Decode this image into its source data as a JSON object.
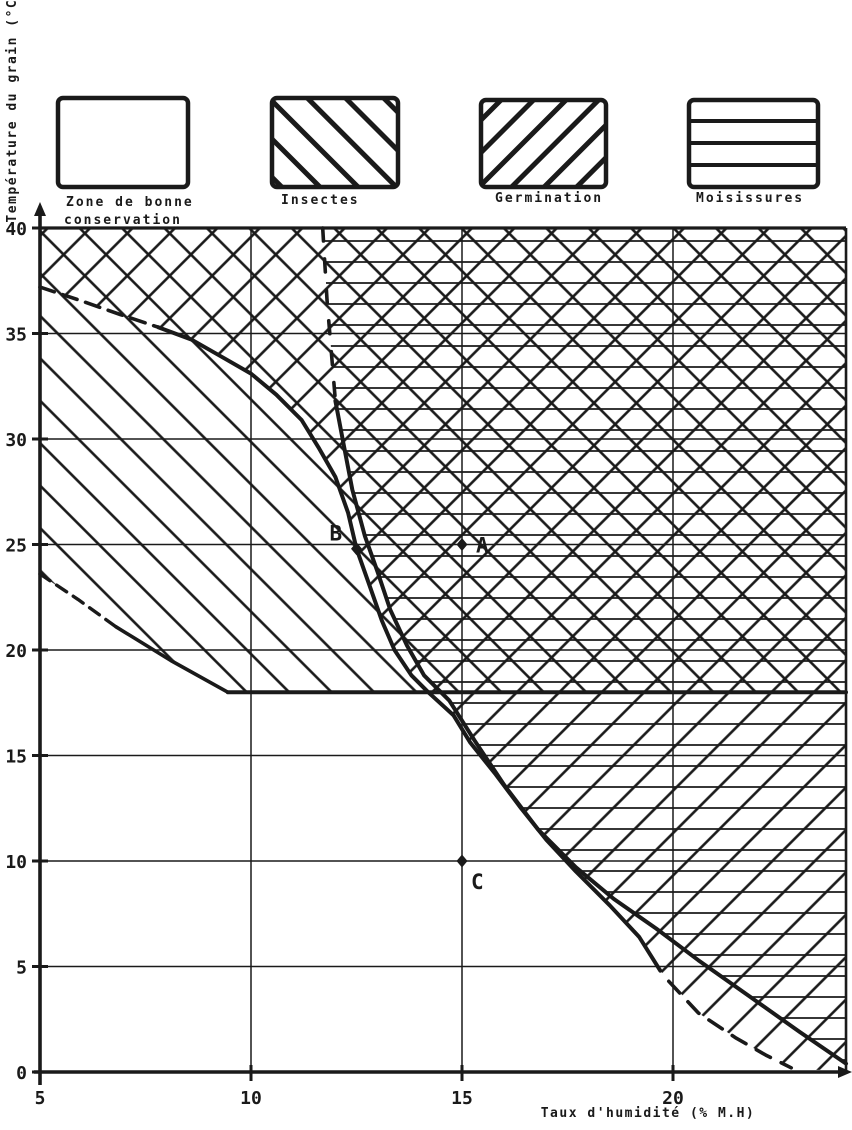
{
  "figure": {
    "bg": "#ffffff",
    "ink": "#1a1a1a"
  },
  "legend": {
    "items": [
      {
        "id": "zone-bonne-conservation",
        "label": "Zone de bonne conservation",
        "label_line1": "Zone de bonne",
        "label_line2": "conservation",
        "pattern": "none"
      },
      {
        "id": "insectes",
        "label": "Insectes",
        "pattern": "diagonal-down"
      },
      {
        "id": "germination",
        "label": "Germination",
        "pattern": "diagonal-up"
      },
      {
        "id": "moisissures",
        "label": "Moisissures",
        "pattern": "horizontal"
      }
    ]
  },
  "chart_data": {
    "type": "area",
    "xlabel": "Taux d'humidité (% M.H)",
    "ylabel": "Température du grain (°C)",
    "x_axis": {
      "range": [
        5,
        24.1
      ],
      "gridlines": [
        10,
        15,
        20
      ],
      "tick_labels": [
        {
          "v": 5,
          "t": "5"
        },
        {
          "v": 10,
          "t": "10"
        },
        {
          "v": 15,
          "t": "15"
        },
        {
          "v": 20,
          "t": "20"
        }
      ]
    },
    "y_axis": {
      "range": [
        0,
        40
      ],
      "gridlines": [
        5,
        10,
        15,
        20,
        25,
        30,
        35
      ],
      "tick_labels": [
        {
          "v": 0,
          "t": "0"
        },
        {
          "v": 5,
          "t": "5"
        },
        {
          "v": 10,
          "t": "10"
        },
        {
          "v": 15,
          "t": "15"
        },
        {
          "v": 20,
          "t": "20"
        },
        {
          "v": 25,
          "t": "25"
        },
        {
          "v": 30,
          "t": "30"
        },
        {
          "v": 35,
          "t": "35"
        },
        {
          "v": 40,
          "t": "40"
        }
      ]
    },
    "calibration": {
      "x": {
        "d0": 5,
        "px0": 40,
        "k": 42.2
      },
      "y": {
        "d0": 0,
        "px0": 1072,
        "k": -21.1
      }
    },
    "zones": [
      {
        "id": "insectes",
        "pattern": "pat-bs",
        "points": [
          [
            5,
            23.6
          ],
          [
            6.8,
            21.1
          ],
          [
            9.45,
            18
          ],
          [
            24.1,
            18
          ],
          [
            24.1,
            40
          ],
          [
            5,
            40
          ]
        ]
      },
      {
        "id": "germination",
        "pattern": "pat-fs",
        "points": [
          [
            5,
            40
          ],
          [
            5,
            37.2
          ],
          [
            5.9,
            36.6
          ],
          [
            6.9,
            35.9
          ],
          [
            7.8,
            35.3
          ],
          [
            8.6,
            34.7
          ],
          [
            9.3,
            33.9
          ],
          [
            10,
            33.1
          ],
          [
            10.6,
            32.1
          ],
          [
            11.2,
            30.9
          ],
          [
            11.6,
            29.6
          ],
          [
            12,
            28.2
          ],
          [
            12.3,
            26.5
          ],
          [
            12.5,
            24.8
          ],
          [
            12.8,
            23.1
          ],
          [
            13.1,
            21.4
          ],
          [
            13.4,
            20
          ],
          [
            13.8,
            18.8
          ],
          [
            14.2,
            18
          ],
          [
            14.8,
            16.9
          ],
          [
            15.2,
            15.6
          ],
          [
            15.8,
            14.1
          ],
          [
            16.4,
            12.5
          ],
          [
            17,
            11
          ],
          [
            17.7,
            9.5
          ],
          [
            18.5,
            7.9
          ],
          [
            19.2,
            6.4
          ],
          [
            19.7,
            4.8
          ],
          [
            20.6,
            2.8
          ],
          [
            21.5,
            1.6
          ],
          [
            22.2,
            0.8
          ],
          [
            22.8,
            0.1
          ],
          [
            24.1,
            0.1
          ],
          [
            24.1,
            40
          ]
        ]
      },
      {
        "id": "moisissures",
        "pattern": "pat-hz",
        "points": [
          [
            11.7,
            40
          ],
          [
            11.8,
            36.6
          ],
          [
            11.9,
            34.2
          ],
          [
            12,
            31.8
          ],
          [
            12.2,
            29.7
          ],
          [
            12.4,
            27.6
          ],
          [
            12.7,
            25.4
          ],
          [
            13,
            23.7
          ],
          [
            13.3,
            21.9
          ],
          [
            13.7,
            20.2
          ],
          [
            14.1,
            18.8
          ],
          [
            14.7,
            17.6
          ],
          [
            15.3,
            15.7
          ],
          [
            16,
            13.6
          ],
          [
            16.8,
            11.5
          ],
          [
            17.7,
            9.7
          ],
          [
            18.6,
            8.2
          ],
          [
            19.6,
            6.8
          ],
          [
            20.6,
            5.3
          ],
          [
            21.8,
            3.6
          ],
          [
            23,
            1.9
          ],
          [
            24.1,
            0.4
          ],
          [
            24.1,
            40
          ]
        ]
      }
    ],
    "curves": [
      {
        "id": "germination-upper-dashed",
        "width": 3.6,
        "dash": "15 9",
        "points": [
          [
            5,
            37.2
          ],
          [
            5.9,
            36.6
          ],
          [
            6.9,
            35.9
          ],
          [
            7.8,
            35.3
          ]
        ]
      },
      {
        "id": "germination-main",
        "width": 4,
        "dash": null,
        "points": [
          [
            7.8,
            35.3
          ],
          [
            8.6,
            34.7
          ],
          [
            9.3,
            33.9
          ],
          [
            10,
            33.1
          ],
          [
            10.6,
            32.1
          ],
          [
            11.2,
            30.9
          ],
          [
            11.6,
            29.6
          ],
          [
            12,
            28.2
          ],
          [
            12.3,
            26.5
          ],
          [
            12.5,
            24.8
          ],
          [
            12.8,
            23.1
          ],
          [
            13.1,
            21.4
          ],
          [
            13.4,
            20
          ],
          [
            13.8,
            18.8
          ],
          [
            14.2,
            18
          ],
          [
            14.8,
            16.9
          ],
          [
            15.2,
            15.6
          ],
          [
            15.8,
            14.1
          ],
          [
            16.4,
            12.5
          ],
          [
            17,
            11
          ],
          [
            17.7,
            9.5
          ],
          [
            18.5,
            7.9
          ],
          [
            19.2,
            6.4
          ],
          [
            19.7,
            4.8
          ]
        ]
      },
      {
        "id": "germination-lower-dashed",
        "width": 3.6,
        "dash": "16 12",
        "points": [
          [
            19.9,
            4.3
          ],
          [
            20.6,
            2.8
          ],
          [
            21.5,
            1.6
          ],
          [
            22.2,
            0.8
          ],
          [
            22.8,
            0.2
          ]
        ]
      },
      {
        "id": "moisissures-upper-dashed",
        "width": 3.6,
        "dash": "13 18",
        "points": [
          [
            11.7,
            40
          ],
          [
            11.8,
            36.6
          ],
          [
            11.9,
            34.2
          ],
          [
            12,
            31.8
          ]
        ]
      },
      {
        "id": "moisissures-main",
        "width": 4,
        "dash": null,
        "points": [
          [
            12,
            31.8
          ],
          [
            12.2,
            29.7
          ],
          [
            12.4,
            27.6
          ],
          [
            12.7,
            25.4
          ],
          [
            13,
            23.7
          ],
          [
            13.3,
            21.9
          ],
          [
            13.7,
            20.2
          ],
          [
            14.1,
            18.8
          ],
          [
            14.7,
            17.6
          ],
          [
            15.3,
            15.7
          ],
          [
            16,
            13.6
          ],
          [
            16.8,
            11.5
          ],
          [
            17.7,
            9.7
          ],
          [
            18.6,
            8.2
          ],
          [
            19.6,
            6.8
          ],
          [
            20.6,
            5.3
          ],
          [
            21.8,
            3.6
          ],
          [
            23,
            1.9
          ],
          [
            24.1,
            0.4
          ]
        ]
      },
      {
        "id": "insectes-lower-dashed",
        "width": 3.4,
        "dash": "12 8",
        "points": [
          [
            5,
            23.6
          ],
          [
            5.9,
            22.4
          ],
          [
            6.8,
            21.1
          ]
        ]
      },
      {
        "id": "insectes-lower-solid",
        "width": 3.6,
        "dash": null,
        "points": [
          [
            6.8,
            21.1
          ],
          [
            8.1,
            19.5
          ],
          [
            9.45,
            18
          ]
        ]
      },
      {
        "id": "limit-18-degrees",
        "width": 4,
        "dash": null,
        "points": [
          [
            9.45,
            18
          ],
          [
            24.1,
            18
          ]
        ]
      }
    ],
    "points": [
      {
        "label": "A",
        "x": 15,
        "y": 25,
        "dx": 14,
        "dy": 8
      },
      {
        "label": "B",
        "x": 12.5,
        "y": 24.8,
        "dx": -27,
        "dy": -8
      },
      {
        "label": "C",
        "x": 15,
        "y": 10,
        "dx": 9,
        "dy": 28
      }
    ]
  }
}
